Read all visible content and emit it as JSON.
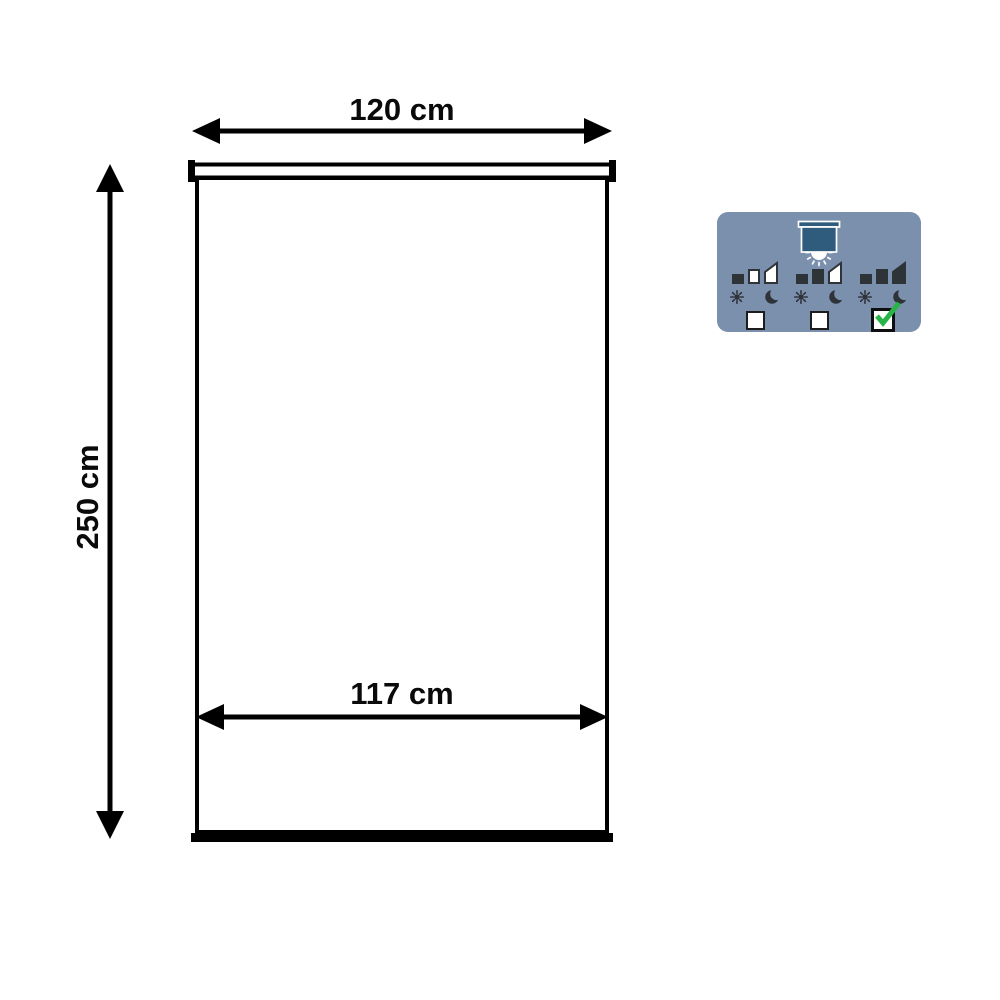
{
  "diagram": {
    "width_label": "120 cm",
    "height_label": "250 cm",
    "fabric_width_label": "117 cm"
  },
  "badge": {
    "background_color": "#7a90ad",
    "blind_color": "#2f5b7d",
    "icon_color": "#2e3338",
    "check_color": "#28b446",
    "options": [
      {
        "icon": "opacity-level-light-filtering",
        "level": 1,
        "checked": false
      },
      {
        "icon": "opacity-level-semi-darkening",
        "level": 2,
        "checked": false
      },
      {
        "icon": "opacity-level-darkening",
        "level": 3,
        "checked": true
      }
    ]
  }
}
